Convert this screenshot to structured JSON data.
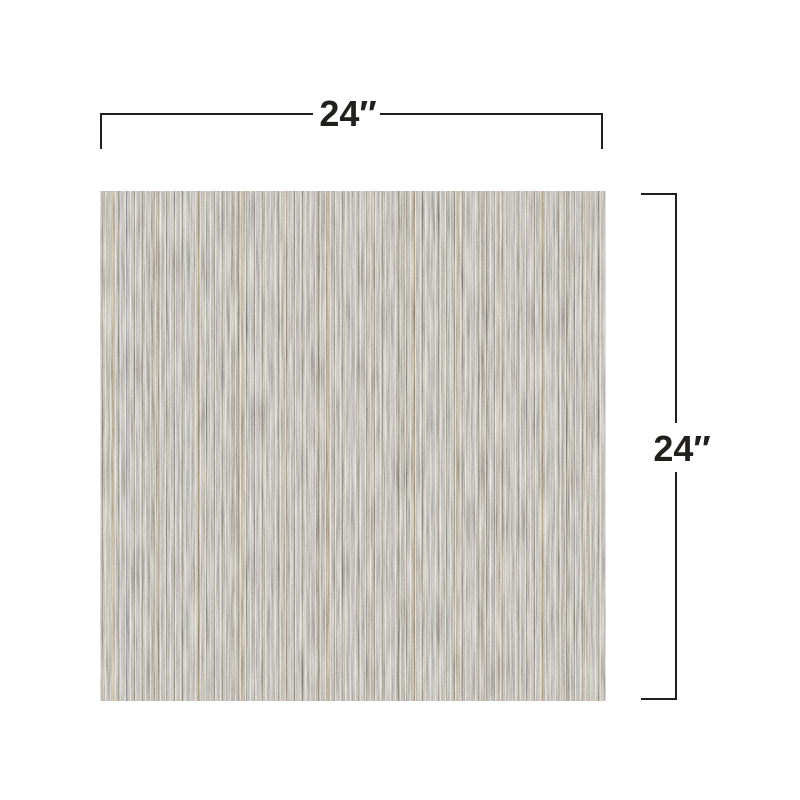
{
  "page": {
    "background_color": "#ffffff"
  },
  "diagram": {
    "type": "product-dimension-diagram",
    "swatch": {
      "base_color": "#99948b",
      "light_streak_color": "#c6c1b5",
      "dark_streak_color": "#5e584f",
      "rust_streak_color": "#a06f3e",
      "blue_streak_color": "#8296a4"
    },
    "dimension_line_color": "#221f1f",
    "dimension_text_color": "#221f1f",
    "dimensions": {
      "width": {
        "label": "24″"
      },
      "height": {
        "label": "24″"
      }
    }
  }
}
